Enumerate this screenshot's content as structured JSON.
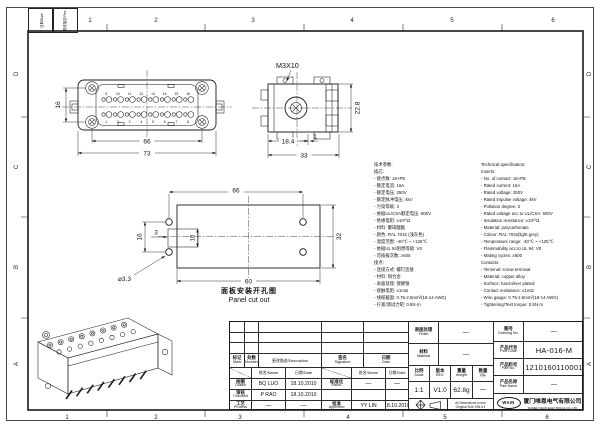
{
  "frame": {
    "cols": [
      "1",
      "2",
      "3",
      "4",
      "5",
      "6"
    ],
    "rows": [
      "D",
      "C",
      "B",
      "A"
    ],
    "rev_date_label": "日期/Date",
    "rev_desc_label": "更改描述 Rev."
  },
  "views": {
    "face": {
      "pins_top": [
        "9",
        "10",
        "11",
        "12",
        "13",
        "14",
        "15",
        "16"
      ],
      "pins_bottom": [
        "1",
        "2",
        "3",
        "4",
        "5",
        "6",
        "7",
        "8"
      ],
      "dim_vert": "16",
      "dim_inner": "66",
      "dim_outer": "73"
    },
    "side": {
      "callout": "M3X10",
      "dim_a": "18.4",
      "dim_b": "1",
      "dim_c": "33",
      "dim_d": "22.8"
    },
    "panel": {
      "dim_top": "66",
      "dim_left": "16",
      "dim_notch_off": "3",
      "dim_notch_h": "10",
      "dim_right": "32",
      "dim_bottom": "60",
      "dim_hole": "⌀3.3",
      "caption_zh": "面板安装开孔图",
      "caption_en": "Panel cut out"
    }
  },
  "specs": {
    "zh": [
      "技术参数:",
      "插芯:",
      "- 接点数: 16+PE",
      "- 额定电流: 16A",
      "- 额定电压: 250V",
      "- 额定脉冲电压: 4kV",
      "- 污染等级: 3",
      "- 依据UL/CSA额定电压: 600V",
      "- 绝缘电阻: ≥10¹⁰Ω",
      "- 材料: 聚碳酸酯",
      "- 颜色: RAL 7032 (浅灰色)",
      "- 温度范围: -40℃ ~ +125℃",
      "- 依据UL 94阻燃等级: V0",
      "- 可插拔次数: ≥500",
      "接点:",
      "- 连接方式: 螺钉连接",
      "- 材料: 铜合金",
      "- 表面处理: 镀硬银",
      "- 接触电阻: ≤1mΩ",
      "- 线缆截面: 0.75-2.5mm²(18-14 AWG)",
      "- 拧紧/测试力矩: 0.5N·m"
    ],
    "en": [
      "Technical specification:",
      "Inserts:",
      "- No. of contact: 16+PE",
      "- Rated current: 16A",
      "- Rated voltage: 250V",
      "- Rated impulse voltage: 4kV",
      "- Pollution degree: 3",
      "- Rated voltage acc.to UL/CSA: 600V",
      "- Insulation resistance: ≥10¹⁰Ω",
      "- Material: polycarbonate",
      "- Colour: RAL 7032(light grey)",
      "- Temperature range: -40℃ ~ +125℃",
      "- Flammability acc.to UL 94: V0",
      "- Mating cycles: ≥500",
      "Contacts:",
      "- Terminal: screw terminal",
      "- Material: copper alloy",
      "- Surface: hard-silver plated",
      "- Contact resistance: ≤1mΩ",
      "- Wire gauge: 0.75-2.5mm²(18-14 AWG)",
      "- Tightening/Test torque: 0.5N·m"
    ]
  },
  "tb": {
    "mark": {
      "zh": "标记",
      "en": "Mark"
    },
    "number": {
      "zh": "处数",
      "en": "Number"
    },
    "desc": "更改描述/Description",
    "signature": {
      "zh": "签名",
      "en": "Signature"
    },
    "date": {
      "zh": "日期",
      "en": "Date"
    },
    "name_date": {
      "name": "姓名/Name",
      "date": "日期/Date"
    },
    "drawn": {
      "zh": "绘图",
      "en": "Drawn"
    },
    "drawn_name": "BQ LUO",
    "drawn_date": "18.10.2010",
    "stand": {
      "zh": "标准化",
      "en": "Stand."
    },
    "stand_name": "—",
    "stand_date": "—",
    "checked": {
      "zh": "审核",
      "en": "Checked"
    },
    "checked_name": "P RAO",
    "checked_date": "18.10.2010",
    "process": {
      "zh": "工艺",
      "en": "Process"
    },
    "process_name": "—",
    "process_date": "—",
    "approved": {
      "zh": "批准",
      "en": "Approved"
    },
    "approved_name": "YY LIN",
    "approved_date": "18.10.2010",
    "finish": {
      "zh": "表面处理",
      "en": "Finish"
    },
    "finish_val": "—",
    "material": {
      "zh": "材料",
      "en": "Material"
    },
    "material_val": "—",
    "scale": {
      "zh": "比例",
      "en": "Scale"
    },
    "scale_val": "1:1",
    "rev": {
      "zh": "版本",
      "en": "REV."
    },
    "rev_val": "V1.0",
    "weight": {
      "zh": "重量",
      "en": "Weight"
    },
    "weight_val": "62.8g",
    "qty": {
      "zh": "数量",
      "en": "Qty."
    },
    "qty_val": "—",
    "note1": "All Dimensions in mm",
    "note2": "Original Size DIN A 4",
    "drawing_no": {
      "zh": "图号",
      "en": "Drawing No."
    },
    "drawing_no_val": "—",
    "part_code": {
      "zh": "产品代号",
      "en": "Part Code"
    },
    "part_code_val": "HA-016-M",
    "part_no": {
      "zh": "产品料号",
      "en": "Part No."
    },
    "part_no_val": "1210160110001",
    "part_name": {
      "zh": "产品名称",
      "en": "Part Name"
    },
    "part_name_val": "—",
    "logo": "WAIN",
    "company_zh": "厦门唯恩电气有限公司",
    "company_en": "XIAMEN WAIN ELECTRICAL CO.,LTD"
  }
}
